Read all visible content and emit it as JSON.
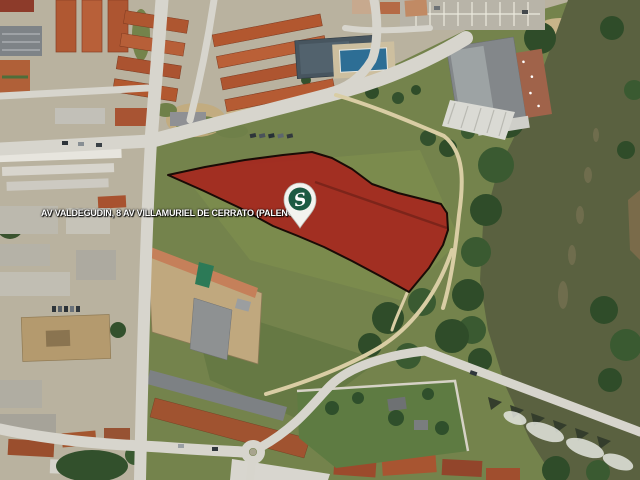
{
  "map": {
    "address_label": "AV VALDEGUDIN, 8 AV VILLAMURIEL DE CERRATO (PALENCIA)",
    "marker": {
      "letter": "S"
    },
    "colors": {
      "parcel_fill": "#A6251E",
      "parcel_fill_opacity": "0.9",
      "parcel_stroke": "#1A0B06",
      "pin_body": "#F3F3EF",
      "pin_ball": "#1D5A43",
      "pin_letter": "#FFFFFF"
    }
  }
}
